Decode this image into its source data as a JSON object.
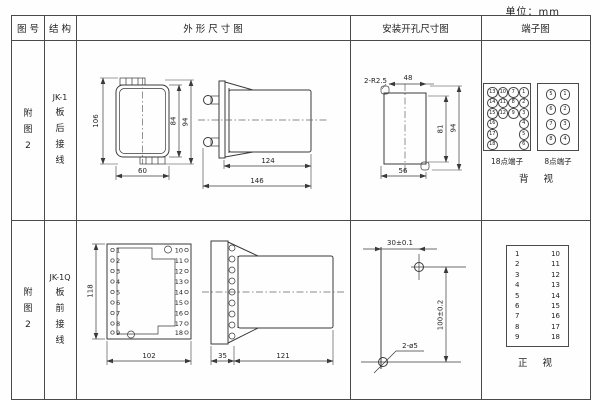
{
  "unit": "单位：mm",
  "header": {
    "fig_no": "图 号",
    "structure": "结 构",
    "outline": "外  形  尺  寸  图",
    "install": "安装开孔尺寸图",
    "terminal": "端子图"
  },
  "row1": {
    "fig": [
      "附",
      "图",
      "2"
    ],
    "structure": [
      "JK-1",
      "板",
      "后",
      "接",
      "线"
    ],
    "front": {
      "height": "106",
      "inner_height": "84",
      "outer_height": "94",
      "width": "60"
    },
    "side": {
      "body_len": "124",
      "total_len": "146"
    },
    "install": {
      "radius": "2-R2.5",
      "top_width": "48",
      "inner_height": "81",
      "outer_height": "94",
      "bottom_width": "56"
    },
    "t18": {
      "label": "18点端子",
      "cells": [
        "13",
        "10",
        "7",
        "1",
        "14",
        "11",
        "8",
        "2",
        "15",
        "12",
        "9",
        "3",
        "16",
        "",
        "",
        "4",
        "17",
        "",
        "",
        "5",
        "18",
        "",
        "",
        "6"
      ]
    },
    "t8": {
      "label": "8点端子",
      "cells": [
        "5",
        "1",
        "6",
        "2",
        "7",
        "3",
        "8",
        "4"
      ]
    },
    "view": "背 视"
  },
  "row2": {
    "fig": [
      "附",
      "图",
      "2"
    ],
    "structure": [
      "JK-1Q",
      "板",
      "前",
      "接",
      "线"
    ],
    "front": {
      "height": "118",
      "width": "102",
      "left": [
        "1",
        "2",
        "3",
        "4",
        "5",
        "6",
        "7",
        "8",
        "9"
      ],
      "right": [
        "10",
        "11",
        "12",
        "13",
        "14",
        "15",
        "16",
        "17",
        "18"
      ]
    },
    "side": {
      "flange": "35",
      "body": "121"
    },
    "install": {
      "h_dist": "30±0.1",
      "v_dist": "100±0.2",
      "holes": "2-ø5"
    },
    "tbox": {
      "left": [
        "1",
        "2",
        "3",
        "4",
        "5",
        "6",
        "7",
        "8",
        "9"
      ],
      "right": [
        "10",
        "11",
        "12",
        "13",
        "14",
        "15",
        "16",
        "17",
        "18"
      ]
    },
    "view": "正 视"
  }
}
